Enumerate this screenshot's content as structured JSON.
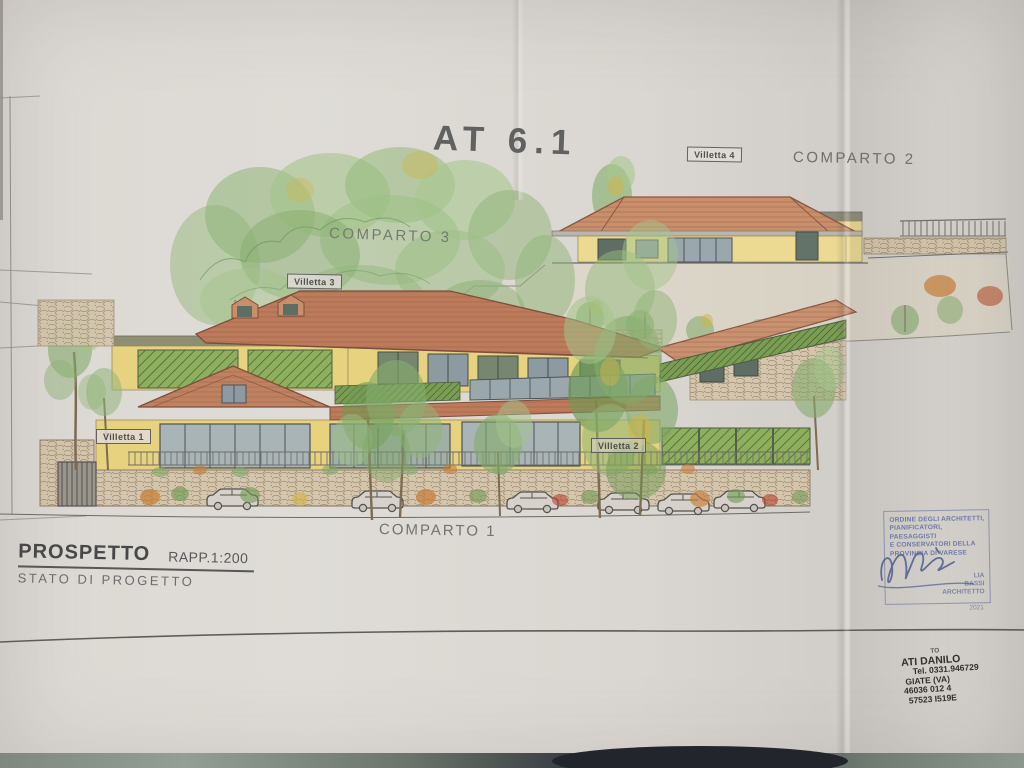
{
  "title": "AT 6.1",
  "areas": {
    "comparto1": "COMPARTO 1",
    "comparto2": "COMPARTO 2",
    "comparto3": "COMPARTO 3"
  },
  "buildings": {
    "villetta1": "Villetta 1",
    "villetta2": "Villetta 2",
    "villetta3": "Villetta 3",
    "villetta4": "Villetta 4"
  },
  "title_block": {
    "name": "PROSPETTO",
    "scale": "RAPP.1:200",
    "status": "STATO DI PROGETTO"
  },
  "stamps": {
    "architect_order": {
      "lines": [
        "ORDINE DEGLI ARCHITETTI,",
        "PIANIFICATORI, PAESAGGISTI",
        "E CONSERVATORI DELLA",
        "PROVINCIA DI VARESE"
      ],
      "name_lines": [
        "LIA",
        "BASSI",
        "ARCHITETTO"
      ],
      "number": "2021",
      "ink_color": "#6e7aa3"
    },
    "surveyor": {
      "lines": [
        "TO",
        "ATI DANILO",
        "Tel. 0331.946729",
        "GIATE (VA)",
        "46036 012 4",
        "57523 I519E"
      ],
      "ink_color": "#33302b"
    }
  },
  "palette": {
    "paper": "#dad6d1",
    "table_surface": "#3a3f42",
    "roof_terracotta": "#bd7b5c",
    "wall_yellow": "#e7d27f",
    "foliage_green": "#86ab6c",
    "stone": "#d4c6ac",
    "glass": "#a9b4b6",
    "pencil_gray": "#6a6a6a"
  }
}
